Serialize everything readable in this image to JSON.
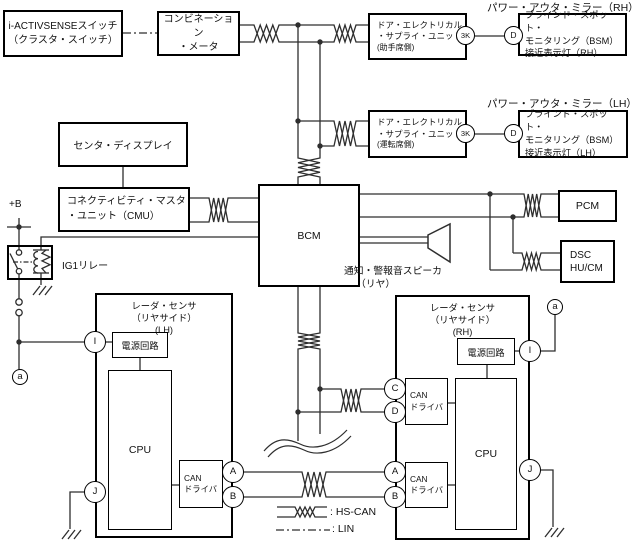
{
  "labels": {
    "power_mirror_rh": "パワー・アウタ・ミラー（RH）",
    "power_mirror_lh": "パワー・アウタ・ミラー（LH）",
    "plus_b": "+B",
    "ig1_relay": "IG1リレー",
    "speaker_line1": "通知・警報音スピーカ",
    "speaker_line2": "（リヤ）",
    "legend_hscan": ": HS-CAN",
    "legend_lin": ": LIN"
  },
  "boxes": {
    "iactivsense_switch": {
      "line1": "i-ACTIVSENSEスイッチ",
      "line2": "（クラスタ・スイッチ）"
    },
    "combination_meter": {
      "line1": "コンビネーション",
      "line2": "・メータ"
    },
    "door_unit_rh": {
      "line1": "ドア・エレクトリカル",
      "line2": "・サプライ・ユニット",
      "line3": "(助手席側)"
    },
    "door_unit_lh": {
      "line1": "ドア・エレクトリカル",
      "line2": "・サプライ・ユニット",
      "line3": "(運転席側)"
    },
    "bsm_lamp_rh": {
      "line1": "ブラインド・スポット・",
      "line2": "モニタリング（BSM）",
      "line3": "接近表示灯（RH）"
    },
    "bsm_lamp_lh": {
      "line1": "ブラインド・スポット・",
      "line2": "モニタリング（BSM）",
      "line3": "接近表示灯（LH）"
    },
    "center_display": {
      "line1": "センタ・ディスプレイ"
    },
    "cmu": {
      "line1": "コネクティビティ・マスタ",
      "line2": "・ユニット（CMU）"
    },
    "bcm": {
      "line1": "BCM"
    },
    "pcm": {
      "line1": "PCM"
    },
    "dsc": {
      "line1": "DSC",
      "line2": "HU/CM"
    },
    "radar_lh": {
      "line1": "レーダ・センサ",
      "line2": "（リヤサイド）",
      "line3": "(LH)"
    },
    "radar_rh": {
      "line1": "レーダ・センサ",
      "line2": "（リヤサイド）",
      "line3": "(RH)"
    },
    "power_circuit": "電源回路",
    "cpu": "CPU",
    "can_driver": {
      "line1": "CAN",
      "line2": "ドライバ"
    }
  },
  "connectors": {
    "a": "a",
    "i": "I",
    "j": "J",
    "A": "A",
    "B": "B",
    "C": "C",
    "D": "D",
    "k3": "3K"
  }
}
